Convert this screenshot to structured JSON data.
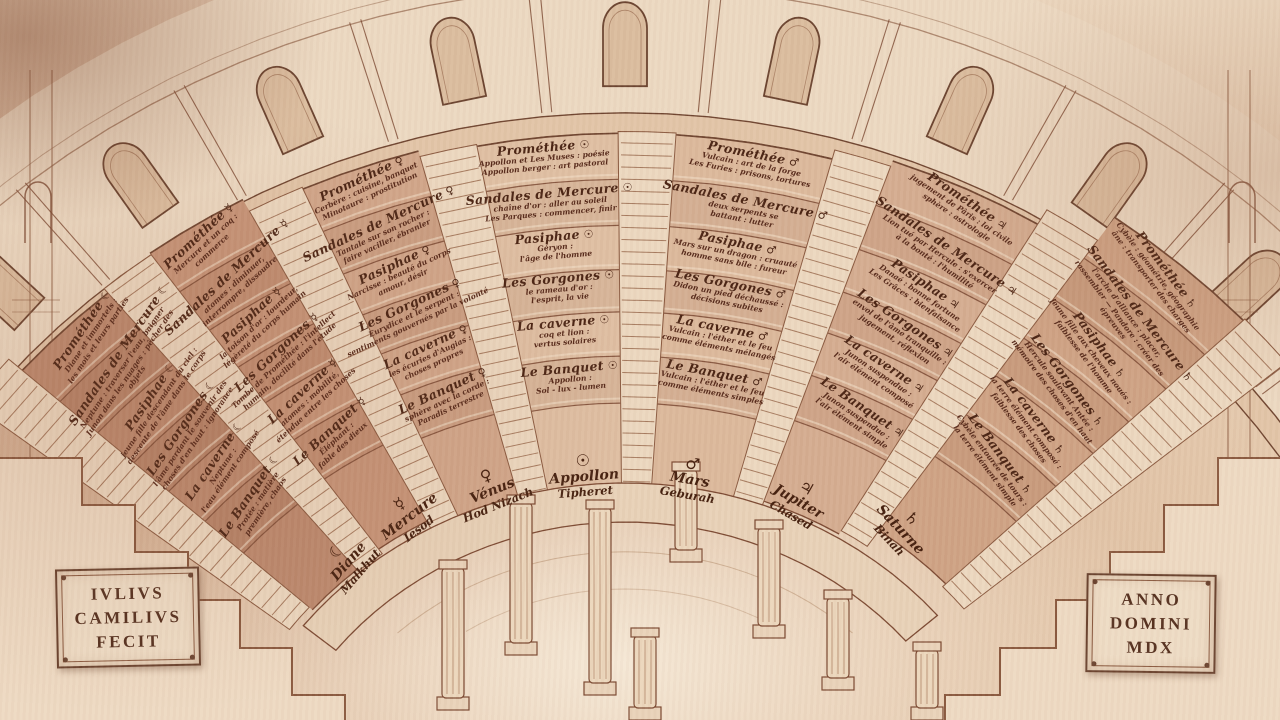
{
  "plaques": {
    "left": [
      "IVLIVS",
      "CAMILIVS",
      "FECIT"
    ],
    "right": [
      "ANNO",
      "DOMINI",
      "MDX"
    ]
  },
  "theatre": {
    "grades_top_to_bottom": [
      "Prométhée",
      "Sandales de Mercure",
      "Pasiphae",
      "Les Gorgones",
      "La caverne",
      "Le Banquet"
    ],
    "sectors": [
      {
        "planet": "Lune",
        "symbol": "☾",
        "sephira": "Malkhut",
        "base_name": "Diane",
        "tiers": [
          {
            "grade": "Prométhée",
            "lines": [
              "Diane et immortels :",
              "les mois et leurs parties"
            ]
          },
          {
            "grade": "Sandales de Mercure",
            "lines": [
              "Neptune : traverser l'eau, baigner",
              "Junon dans les nuages : pêcher des objets"
            ]
          },
          {
            "grade": "Pasiphae",
            "lines": [
              "jeune fille descendant du ciel :",
              "descente de l'âme dans le corps"
            ]
          },
          {
            "grade": "Les Gorgones",
            "lines": [
              "l'âme perdant le souvenir des",
              "choses d'en haut : ignorance"
            ]
          },
          {
            "grade": "La caverne",
            "lines": [
              "Neptune :",
              "l'eau élément composé"
            ]
          },
          {
            "grade": "Le Banquet",
            "lines": [
              "Protée : matière",
              "première, chaos"
            ]
          }
        ]
      },
      {
        "planet": "Mercure",
        "symbol": "☿",
        "sephira": "Iesod",
        "base_name": "Mercure",
        "tiers": [
          {
            "grade": "Prométhée",
            "lines": [
              "Mercure et un coq :",
              "commerce"
            ]
          },
          {
            "grade": "Sandales de Mercure",
            "lines": [
              "atomes : diminuer,",
              "interrompre, dissoudre"
            ]
          },
          {
            "grade": "Pasiphae",
            "lines": [
              "la toison d'or : lourdeur,",
              "légèreté du corps humain"
            ]
          },
          {
            "grade": "Les Gorgones",
            "lines": [
              "Tombe de Prométhée : l'intellect",
              "humain, docilité dans l'étude"
            ]
          },
          {
            "grade": "La caverne",
            "lines": [
              "atomes : mobilité,",
              "étendue entre les choses"
            ]
          },
          {
            "grade": "Le Banquet",
            "lines": [
              "Éléphant :",
              "fable des dieux"
            ]
          }
        ]
      },
      {
        "planet": "Vénus",
        "symbol": "♀",
        "sephira": "Hod Nizach",
        "base_name": "Vénus",
        "tiers": [
          {
            "grade": "Prométhée",
            "lines": [
              "Cerbère : cuisine, banquet",
              "Minotaure : prostitution"
            ]
          },
          {
            "grade": "Sandales de Mercure",
            "lines": [
              "Tantale sur son rocher :",
              "faire vaciller, ébranler"
            ]
          },
          {
            "grade": "Pasiphae",
            "lines": [
              "Narcisse : beauté du corps",
              "amour, désir"
            ]
          },
          {
            "grade": "Les Gorgones",
            "lines": [
              "Eurydice et le serpent :",
              "sentiments gouvernés par la volonté"
            ]
          },
          {
            "grade": "La caverne",
            "lines": [
              "les écuries d'Augias :",
              "choses propres"
            ]
          },
          {
            "grade": "Le Banquet",
            "lines": [
              "sphère avec la corde :",
              "Paradis terrestre"
            ]
          }
        ]
      },
      {
        "planet": "Appollon",
        "symbol": "☉",
        "sephira": "Tipheret",
        "base_name": "Appollon",
        "tiers": [
          {
            "grade": "Prométhée",
            "lines": [
              "Appollon et Les Muses : poésie",
              "Appollon berger : art pastoral"
            ]
          },
          {
            "grade": "Sandales de Mercure",
            "lines": [
              "chaîne d'or : aller au soleil",
              "Les Parques : commencer, finir"
            ]
          },
          {
            "grade": "Pasiphae",
            "lines": [
              "Géryon :",
              "l'âge de l'homme"
            ]
          },
          {
            "grade": "Les Gorgones",
            "lines": [
              "le rameau d'or :",
              "l'esprit, la vie"
            ]
          },
          {
            "grade": "La caverne",
            "lines": [
              "coq et lion :",
              "vertus solaires"
            ]
          },
          {
            "grade": "Le Banquet",
            "lines": [
              "Appollon :",
              "Sol - lux - lumen"
            ]
          }
        ]
      },
      {
        "planet": "Mars",
        "symbol": "♂",
        "sephira": "Geburah",
        "base_name": "Mars",
        "tiers": [
          {
            "grade": "Prométhée",
            "lines": [
              "Vulcain : art de la forge",
              "Les Furies : prisons, tortures"
            ]
          },
          {
            "grade": "Sandales de Mercure",
            "lines": [
              "deux serpents se",
              "battant : lutter"
            ]
          },
          {
            "grade": "Pasiphae",
            "lines": [
              "Mars sur un dragon : cruauté",
              "homme sans bile : fureur"
            ]
          },
          {
            "grade": "Les Gorgones",
            "lines": [
              "Didon un pied déchaussé :",
              "décisions subites"
            ]
          },
          {
            "grade": "La caverne",
            "lines": [
              "Vulcain : l'éther et le feu",
              "comme éléments mélangés"
            ]
          },
          {
            "grade": "Le Banquet",
            "lines": [
              "Vulcain : l'éther et le feu",
              "comme éléments simples"
            ]
          }
        ]
      },
      {
        "planet": "Jupiter",
        "symbol": "♃",
        "sephira": "Chased",
        "base_name": "Jupiter",
        "tiers": [
          {
            "grade": "Prométhée",
            "lines": [
              "jugement de Pâris : loi civile",
              "sphère : astrologie"
            ]
          },
          {
            "grade": "Sandales de Mercure",
            "lines": [
              "Lion tué par Hercule : s'exercer",
              "à la bonté : l'humilité"
            ]
          },
          {
            "grade": "Pasiphae",
            "lines": [
              "Danaé : bonne fortune",
              "Les Grâces : bienfaisance"
            ]
          },
          {
            "grade": "Les Gorgones",
            "lines": [
              "envol de l'âme tranquille :",
              "jugement, réflexion"
            ]
          },
          {
            "grade": "La caverne",
            "lines": [
              "Junon suspendue :",
              "l'air élément composé"
            ]
          },
          {
            "grade": "Le Banquet",
            "lines": [
              "Junon suspendue :",
              "l'air élément simple"
            ]
          }
        ]
      },
      {
        "planet": "Saturne",
        "symbol": "♄",
        "sephira": "Binah",
        "base_name": "Saturne",
        "tiers": [
          {
            "grade": "Prométhée",
            "lines": [
              "Cybèle : géométrie, géographie",
              "âne : transporter des charges"
            ]
          },
          {
            "grade": "Sandales de Mercure",
            "lines": [
              "l'arche d'alliance : placer,",
              "rassembler — Pandore : créer des épreuves"
            ]
          },
          {
            "grade": "Pasiphae",
            "lines": [
              "jeune fille aux cheveux noués :",
              "faiblesse de l'homme"
            ]
          },
          {
            "grade": "Les Gorgones",
            "lines": [
              "Hercule soulevant Antée :",
              "mémoire des choses d'en haut"
            ]
          },
          {
            "grade": "La caverne",
            "lines": [
              "la terre élément composé :",
              "faiblesse des choses"
            ]
          },
          {
            "grade": "Le Banquet",
            "lines": [
              "Cybèle entourée de tours :",
              "la terre élément simple"
            ]
          }
        ]
      }
    ]
  }
}
